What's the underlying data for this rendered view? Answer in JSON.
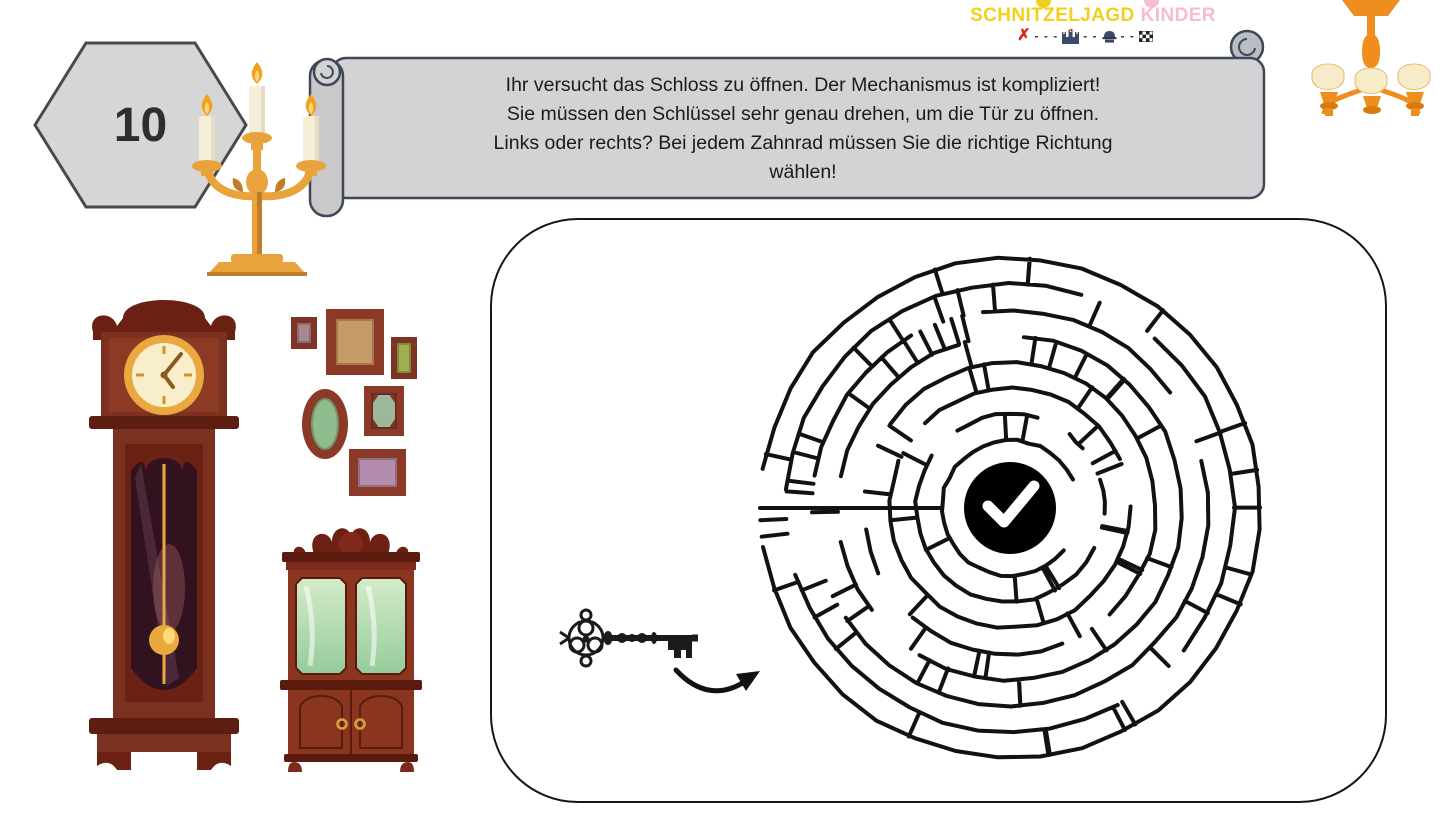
{
  "page": {
    "background": "#ffffff"
  },
  "logo": {
    "title_word1": "SCHNITZELJAGD",
    "title_word2": "KINDER",
    "colors": {
      "yellow": "#f2cf1d",
      "pink": "#f6bcd2",
      "x_red": "#d8291c",
      "trail_dark": "#3d4a63"
    },
    "trail": {
      "start_symbol": "✗",
      "dash1": "- - -",
      "dash2": "- -",
      "dash3": "- -",
      "icons": [
        "x-mark",
        "castle",
        "detective",
        "checkered-flag"
      ]
    }
  },
  "step_badge": {
    "number": "10",
    "fill": "#d6d6d6",
    "border": "#4a4a4a",
    "text_color": "#2e2e2e"
  },
  "banner": {
    "fill": "#d3d3d5",
    "roll_fill": "#c9c9cc",
    "border": "#3e4857",
    "text_color": "#1b1b1b",
    "lines": [
      "Ihr versucht das Schloss zu öffnen. Der Mechanismus ist kompliziert!",
      "Sie müssen den Schlüssel sehr genau drehen, um die Tür zu öffnen.",
      "Links oder rechts? Bei jedem Zahnrad müssen Sie die richtige Richtung",
      "wählen!"
    ]
  },
  "puzzle": {
    "type": "circular-maze",
    "wall_color": "#121212",
    "center_marker": {
      "shape": "circle",
      "fill": "#000000",
      "icon": "checkmark",
      "icon_color": "#ffffff"
    },
    "maze": {
      "rings": 7,
      "inner_radius": 68,
      "outer_radius": 250,
      "seed": 7,
      "entrance_angle_deg": 180
    }
  },
  "decorations": {
    "items": [
      "candelabra",
      "chandelier",
      "grandfather-clock",
      "picture-frames",
      "display-cabinet",
      "antique-key",
      "curved-arrow"
    ],
    "palette": {
      "gold": "#e8a33c",
      "dark_gold": "#c07c2a",
      "orange": "#ef8e1e",
      "wood_dark": "#5d1d10",
      "wood": "#7c3120",
      "wood_light": "#8f3c22",
      "glass_green": "#95cc9b",
      "candle_cream": "#f6efd8",
      "flame": "#f59e1d"
    }
  }
}
